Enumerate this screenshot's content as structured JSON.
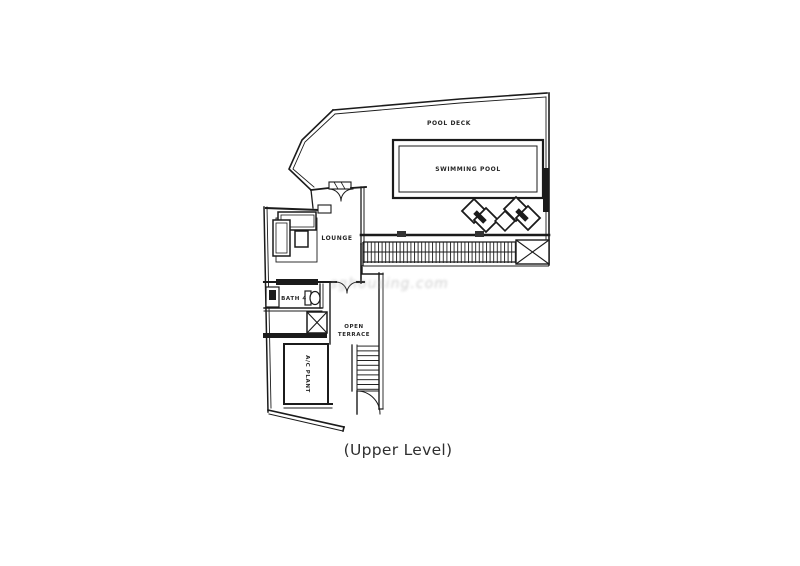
{
  "plan": {
    "caption": "(Upper Level)",
    "watermark": "sghousing.com",
    "labels": {
      "pool_deck": "POOL DECK",
      "swimming_pool": "SWIMMING POOL",
      "lounge": "LOUNGE",
      "bath": "BATH 4",
      "terrace_line1": "OPEN",
      "terrace_line2": "TERRACE",
      "ac_plant": "A/C PLANT"
    },
    "colors": {
      "ink": "#1b1b1b",
      "label": "#262626",
      "paper": "#ffffff",
      "watermark": "#ababab"
    }
  }
}
